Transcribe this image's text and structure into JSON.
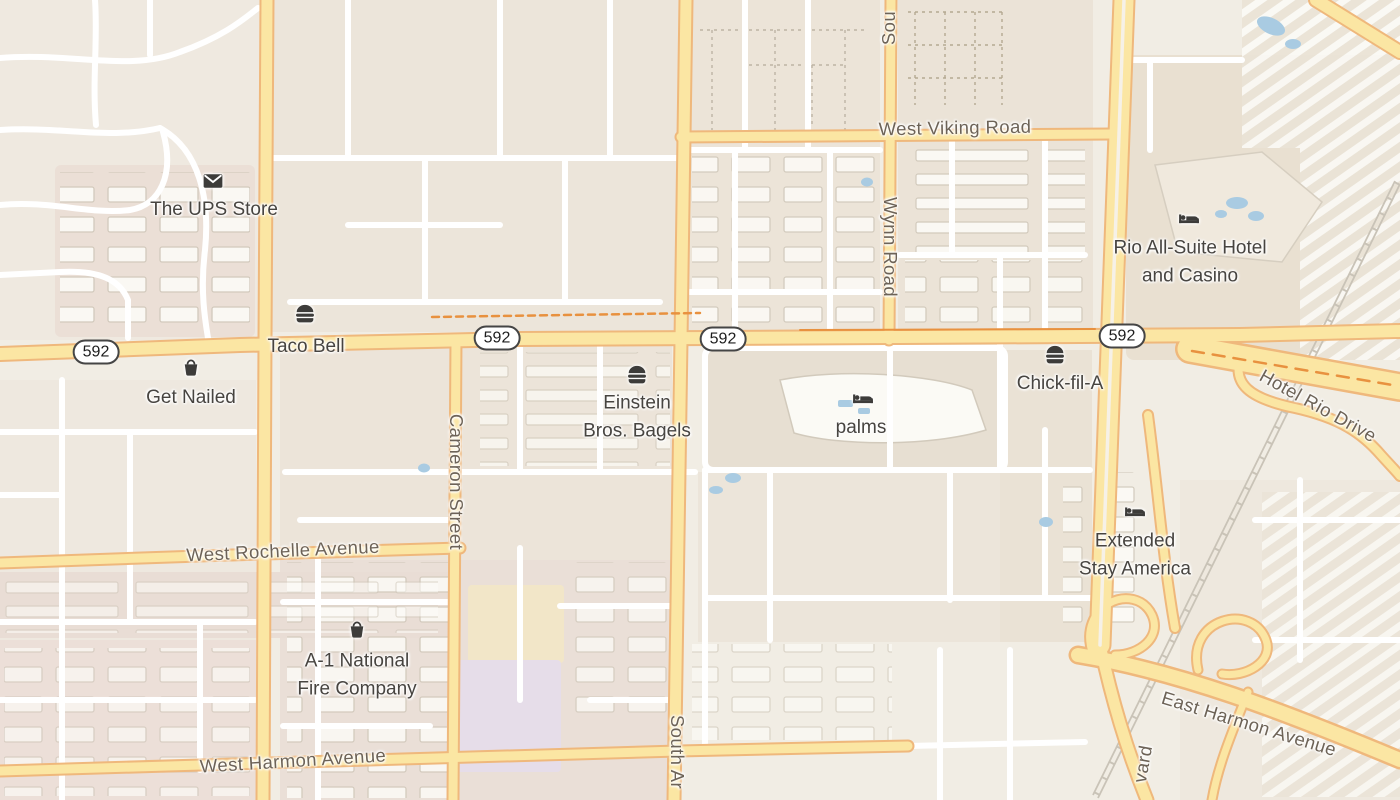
{
  "map": {
    "description": "Street map of the Flamingo Road / Palms area, Las Vegas"
  },
  "colors": {
    "bg": "#f1ede4",
    "road_yellow": "#fbe6a3",
    "road_casing": "#efb87c",
    "road_orange": "#e8913f",
    "road_white": "#ffffff",
    "water": "#a9cbe2",
    "label_street": "#6d6357",
    "label_poi": "#474440",
    "shield_border": "#454545",
    "icon": "#3d3c3a"
  },
  "shield": {
    "route": "592"
  },
  "streets": {
    "viking": "West Viking Road",
    "wynn": "Wynn Road",
    "sou": "Sou",
    "cameron": "Cameron Street",
    "arville": "South Ar",
    "rochelle": "West Rochelle Avenue",
    "harmon_west": "West Harmon Avenue",
    "harmon_east": "East Harmon Avenue",
    "hotel_rio": "Hotel Rio Drive",
    "vard": "vard"
  },
  "pois": {
    "ups": {
      "name": "The UPS Store",
      "icon": "mail"
    },
    "taco_bell": {
      "name": "Taco Bell",
      "icon": "fast-food"
    },
    "get_nailed": {
      "name": "Get Nailed",
      "icon": "shop"
    },
    "einstein": {
      "line1": "Einstein",
      "line2": "Bros. Bagels",
      "icon": "fast-food"
    },
    "palms": {
      "name": "palms",
      "icon": "lodging"
    },
    "chick_fil_a": {
      "name": "Chick-fil-A",
      "icon": "fast-food"
    },
    "rio": {
      "line1": "Rio All-Suite Hotel",
      "line2": "and Casino",
      "icon": "lodging"
    },
    "extended_stay": {
      "line1": "Extended",
      "line2": "Stay America",
      "icon": "lodging"
    },
    "a1_fire": {
      "line1": "A-1 National",
      "line2": "Fire Company",
      "icon": "shop"
    }
  }
}
